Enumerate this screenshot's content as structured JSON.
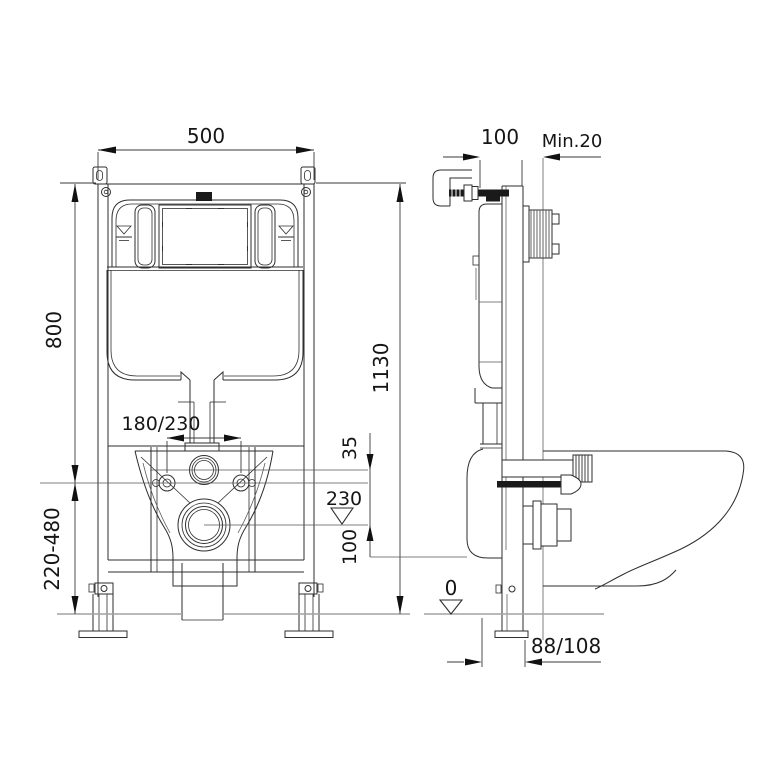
{
  "drawing": {
    "front_view": {
      "dim_frame_width": "500",
      "dim_upper_height": "800",
      "dim_total_height": "1130",
      "dim_foot_range": "220-480",
      "dim_bolt_spacing": "180/230",
      "dim_flush_bolt_gap": "35",
      "dim_drain_height": "230",
      "dim_bolt_drain_gap": "100"
    },
    "side_view": {
      "dim_frame_depth": "100",
      "dim_wall_min": "Min.20",
      "dim_floor_level": "0",
      "dim_drain_distance": "88/108"
    },
    "colors": {
      "line": "#2e2e2e",
      "floor_line": "#a2a2a2",
      "background": "#ffffff"
    }
  }
}
